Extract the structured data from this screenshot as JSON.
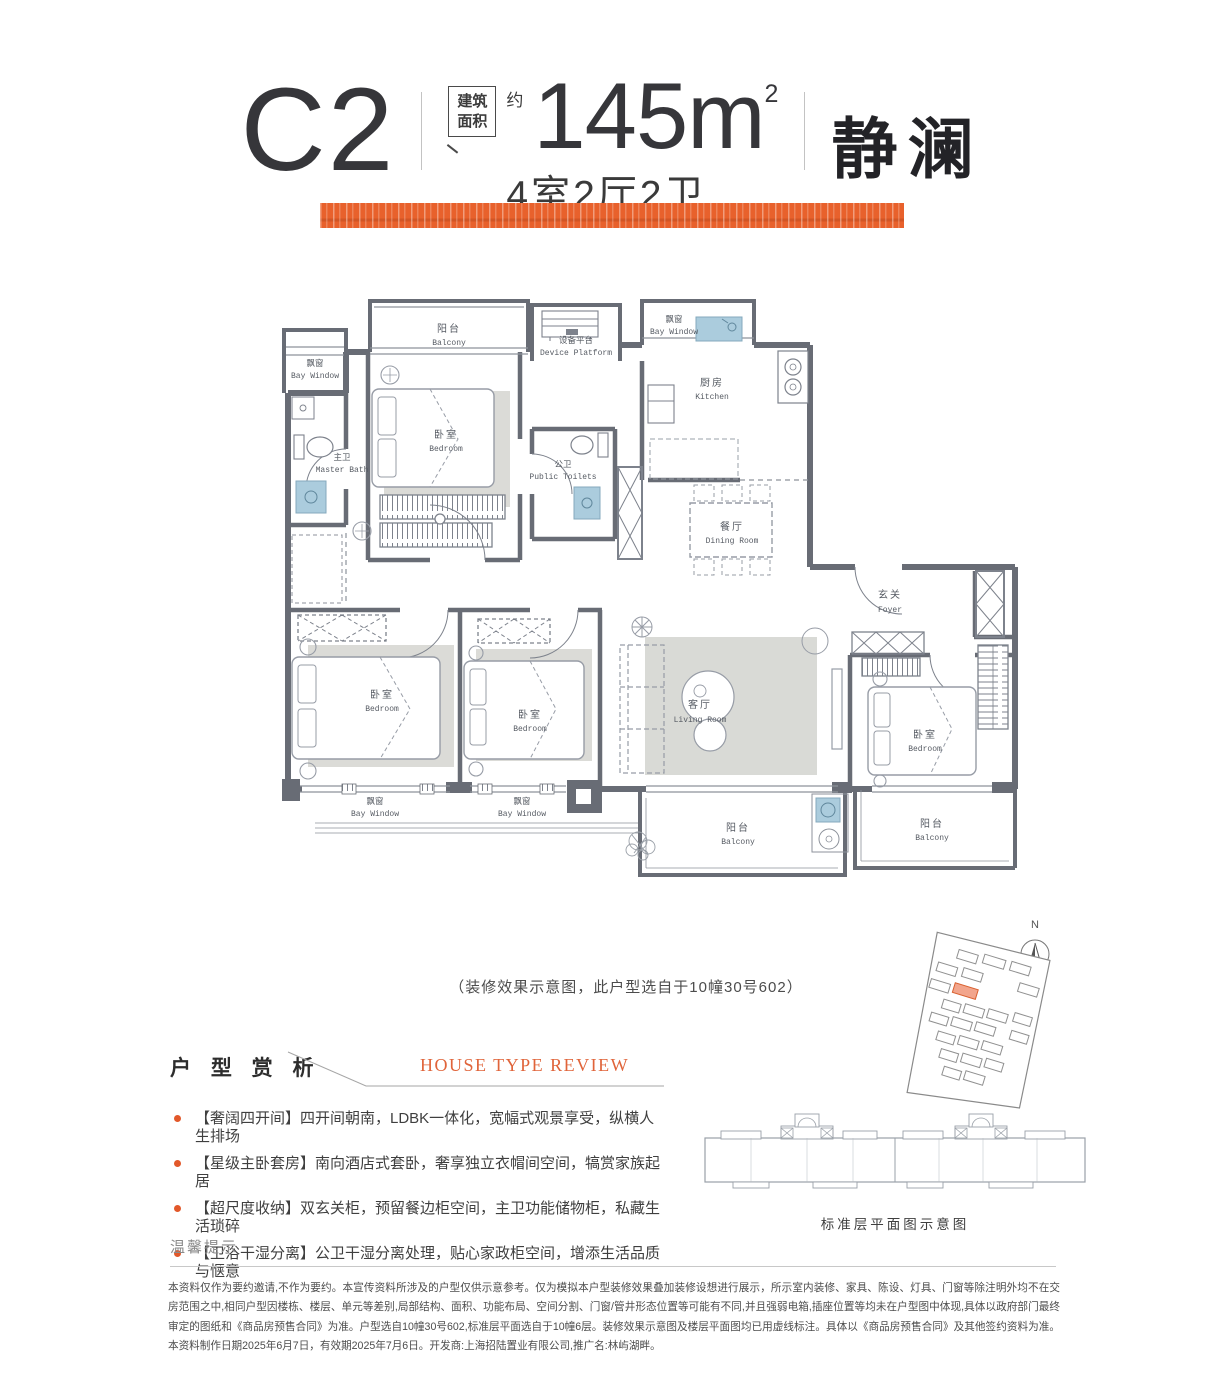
{
  "header": {
    "unit_code": "C2",
    "area_label_line1": "建筑",
    "area_label_line2": "面积",
    "approx": "约",
    "area_value": "145m",
    "area_sup": "2",
    "layout_spec": "4室2厅2卫",
    "unit_name": "静澜"
  },
  "colors": {
    "accent_orange": "#e8612c",
    "wall_gray": "#686c75",
    "fixture_blue": "#abccdd"
  },
  "floorplan": {
    "caption": "（装修效果示意图，此户型选自于10幢30号602）",
    "rooms": [
      {
        "cn": "飘窗",
        "en": "Bay Window"
      },
      {
        "cn": "阳台",
        "en": "Balcony"
      },
      {
        "cn": "设备平台",
        "en": "Device Platform"
      },
      {
        "cn": "飘窗",
        "en": "Bay Window"
      },
      {
        "cn": "厨房",
        "en": "Kitchen"
      },
      {
        "cn": "卧室",
        "en": "Bedroom"
      },
      {
        "cn": "主卫",
        "en": "Master Bath"
      },
      {
        "cn": "公卫",
        "en": "Public Toilets"
      },
      {
        "cn": "餐厅",
        "en": "Dining Room"
      },
      {
        "cn": "玄关",
        "en": "Foyer"
      },
      {
        "cn": "卧室",
        "en": "Bedroom"
      },
      {
        "cn": "卧室",
        "en": "Bedroom"
      },
      {
        "cn": "客厅",
        "en": "Living Room"
      },
      {
        "cn": "卧室",
        "en": "Bedroom"
      },
      {
        "cn": "飘窗",
        "en": "Bay Window"
      },
      {
        "cn": "飘窗",
        "en": "Bay Window"
      },
      {
        "cn": "阳台",
        "en": "Balcony"
      },
      {
        "cn": "阳台",
        "en": "Balcony"
      }
    ]
  },
  "siteplan": {
    "north_label": "N"
  },
  "review": {
    "title_cn": "户 型 赏 析",
    "title_en": "HOUSE TYPE REVIEW",
    "bullets": [
      "【奢阔四开间】四开间朝南，LDBK一体化，宽幅式观景享受，纵横人生排场",
      "【星级主卧套房】南向酒店式套卧，奢享独立衣帽间空间，犒赏家族起居",
      "【超尺度收纳】双玄关柜，预留餐边柜空间，主卫功能储物柜，私藏生活琐碎",
      "【卫浴干湿分离】公卫干湿分离处理，贴心家政柜空间，增添生活品质与惬意"
    ]
  },
  "tips": {
    "title": "温馨提示",
    "disclaimer": "本资料仅作为要约邀请,不作为要约。本宣传资料所涉及的户型仅供示意参考。仅为模拟本户型装修效果叠加装修设想进行展示，所示室内装修、家具、陈设、灯具、门窗等除注明外均不在交房范围之中,相同户型因楼栋、楼层、单元等差别,局部结构、面积、功能布局、空间分割、门窗/管井形态位置等可能有不同,并且强弱电箱,插座位置等均未在户型图中体现,具体以政府部门最终审定的图纸和《商品房预售合同》为准。户型选自10幢30号602,标准层平面选自于10幢6层。装修效果示意图及楼层平面图均已用虚线标注。具体以《商品房预售合同》及其他签约资料为准。本资料制作日期2025年6月7日，有效期2025年7月6日。开发商:上海招陆置业有限公司,推广名:林屿湖畔。"
  },
  "floorplate": {
    "caption": "标准层平面图示意图"
  }
}
